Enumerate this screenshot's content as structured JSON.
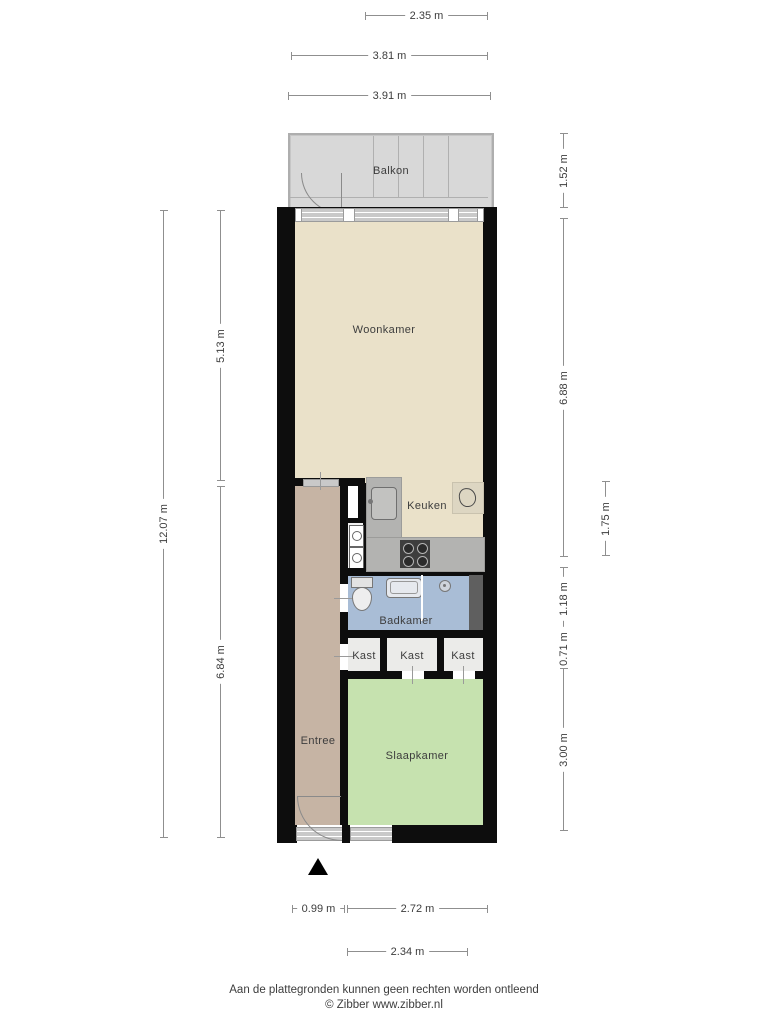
{
  "rooms": {
    "balkon": "Balkon",
    "woonkamer": "Woonkamer",
    "keuken": "Keuken",
    "badkamer": "Badkamer",
    "kast1": "Kast",
    "kast2": "Kast",
    "kast3": "Kast",
    "entree": "Entree",
    "slaapkamer": "Slaapkamer"
  },
  "dimensions": {
    "top": [
      "2.35 m",
      "3.81 m",
      "3.91 m"
    ],
    "bottom": [
      "0.99 m",
      "2.72 m",
      "2.34 m"
    ],
    "left": [
      "12.07 m",
      "5.13 m",
      "6.84 m"
    ],
    "right": [
      "1.52 m",
      "6.88 m",
      "1.75 m",
      "1.18 m",
      "0.71 m",
      "3.00 m"
    ]
  },
  "footer": {
    "disclaimer": "Aan de plattegronden kunnen geen rechten worden ontleend",
    "credit": "© Zibber www.zibber.nl"
  },
  "icons": {
    "north_arrow": "triangle-up",
    "kitchen_sink": "square-basin",
    "stove": "four-burner-grid",
    "boiler": "outlined-blob-tile",
    "toilet": "tank-and-bowl",
    "washbasin": "rounded-rectangle",
    "shower_drain": "circle",
    "washer_dryer": "stacked-appliance-circles",
    "balcony_door": "quarter-arc",
    "entrance_door": "quarter-arc"
  },
  "colors": {
    "wall": "#0d0d0d",
    "floor_living": "#eae1c9",
    "floor_entree": "#c6b4a4",
    "floor_bath": "#a9bdd6",
    "floor_bedroom": "#c6e2af",
    "floor_closet": "#ebebe9",
    "floor_balcony": "#d8d8d8",
    "counter": "#b3b3b1",
    "shaft": "#5f5f5f",
    "dim_line": "#8f8f8f",
    "label_text": "#3d3d3d",
    "fixture_dark": "#3e3e3e"
  }
}
